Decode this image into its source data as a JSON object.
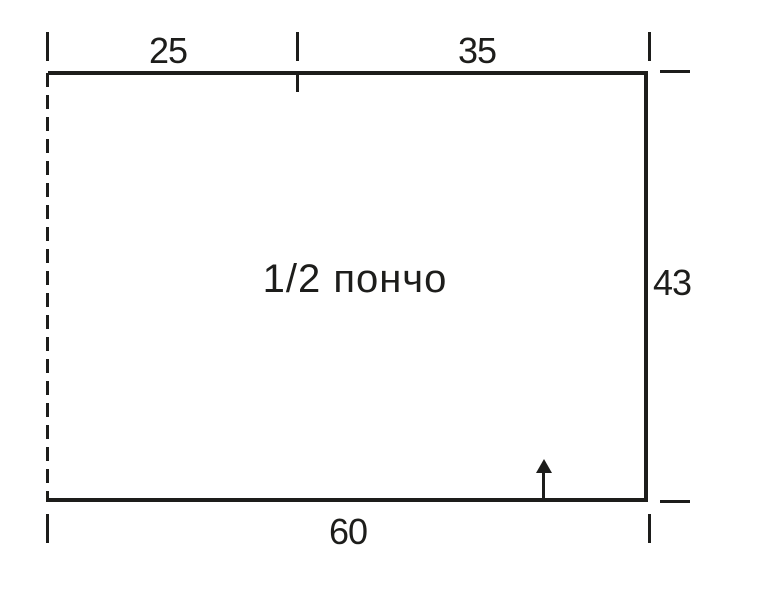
{
  "diagram": {
    "piece_label": "1/2 пончо",
    "measurements": {
      "top_left_width": "25",
      "top_right_width": "35",
      "right_height": "43",
      "bottom_width": "60"
    },
    "icons": {
      "direction_arrow": "up-arrow",
      "fold_line": "dashed-vertical-line"
    },
    "colors": {
      "line": "#1d1d1b",
      "background": "#ffffff"
    }
  }
}
